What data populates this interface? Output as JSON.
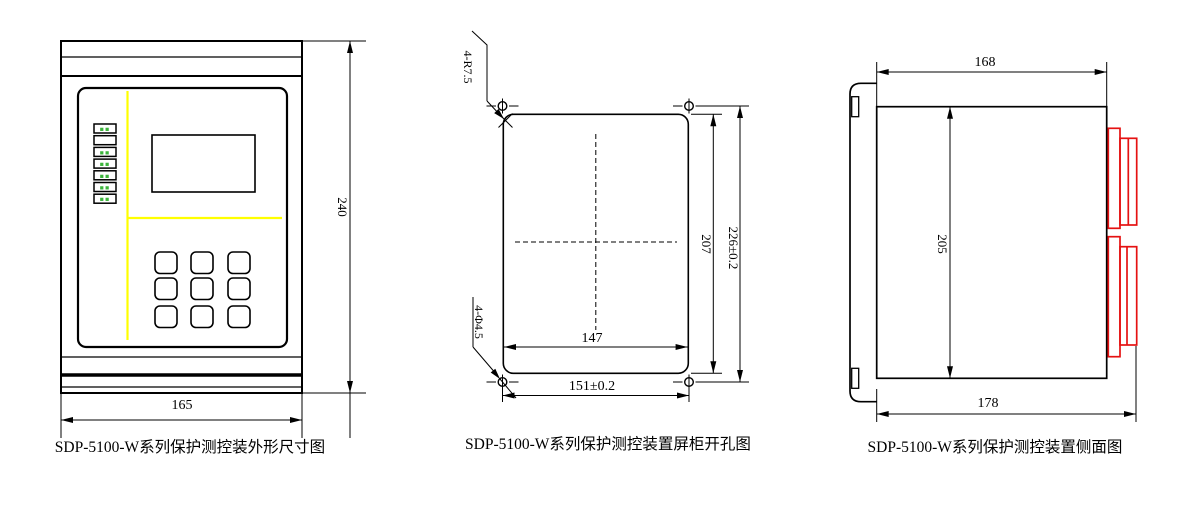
{
  "background": "#ffffff",
  "colors": {
    "line": "#000000",
    "connector_red": "#e51212",
    "panel_yellow": "#ffff00",
    "led_green": "#3cb43c"
  },
  "front_view": {
    "caption": "SDP-5100-W系列保护测控装外形尺寸图",
    "width_dim": "165",
    "height_dim": "240",
    "leds": [
      "▪▪",
      "",
      "▪▪",
      "▪▪",
      "▪▪",
      "▪▪",
      "▪▪"
    ]
  },
  "cutout_view": {
    "caption": "SDP-5100-W系列保护测控装置屏柜开孔图",
    "cutout_width": "147",
    "hole_span_width": "151±0.2",
    "cutout_height": "207",
    "hole_span_height": "226±0.2",
    "corner_radius_note": "4-R7.5",
    "hole_diameter_note": "4-Φ4.5"
  },
  "side_view": {
    "caption": "SDP-5100-W系列保护测控装置侧面图",
    "depth_dim": "168",
    "height_dim": "205",
    "total_depth_dim": "178"
  }
}
